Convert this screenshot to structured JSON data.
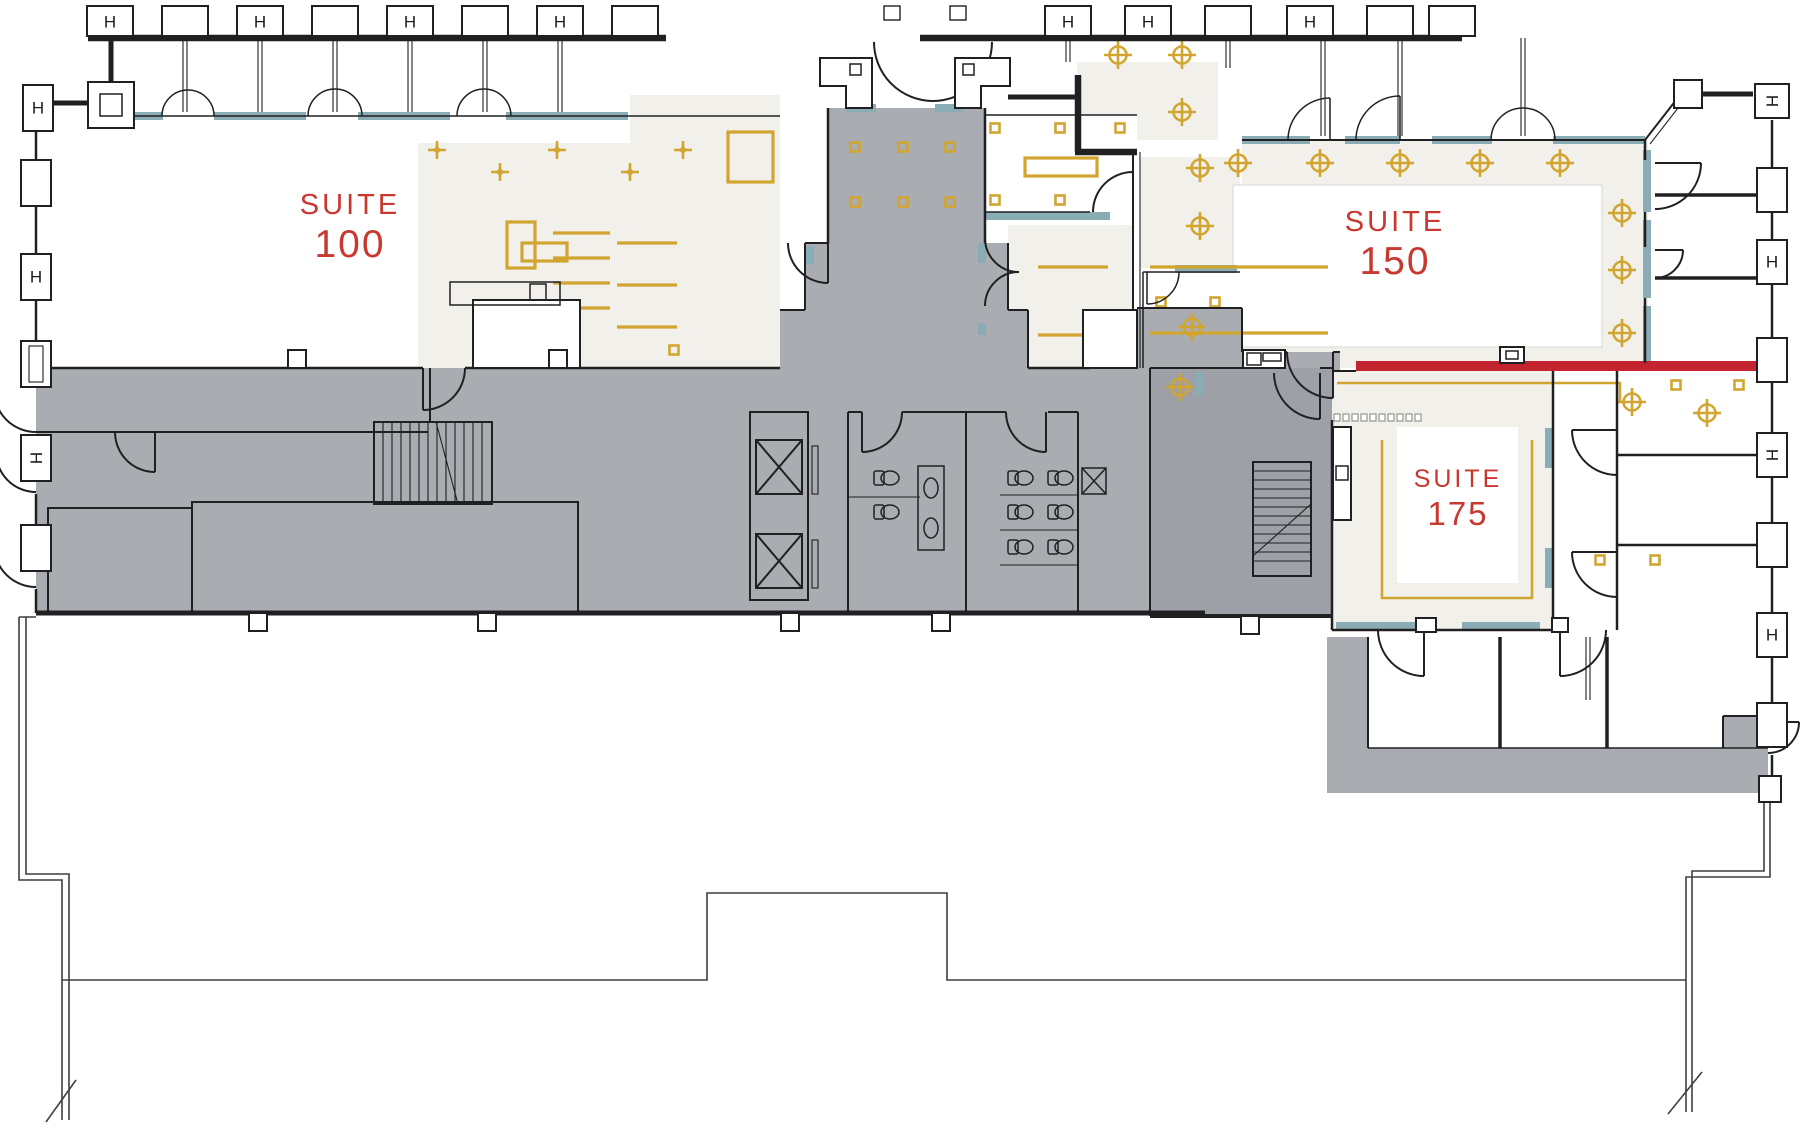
{
  "plan": {
    "type": "office-building-leasing-floor-plan",
    "suites": {
      "suite_100": {
        "name_line": "SUITE",
        "number_line": "100"
      },
      "suite_150": {
        "name_line": "SUITE",
        "number_line": "150"
      },
      "suite_175": {
        "name_line": "SUITE",
        "number_line": "175"
      }
    },
    "symbols": {
      "column_glyph_h": "H",
      "ceiling_light_icon": "crosshair-circle",
      "sprinkler_icon": "four-point-sparkle",
      "ceiling_grid_marker_icon": "small-gold-square",
      "elevator_icon": "x-crossed-shaft",
      "stair_icon": "treads-with-break-line",
      "exit_path_icon": "thin-double-line-with-arrow"
    },
    "colors": {
      "corridor_gray": "#a9acb1",
      "stair_core_gray": "#9da0a6",
      "suite_cream": "#f1f0ea",
      "window_sill_teal": "#8aacb4",
      "accent_gold": "#d1a52f",
      "suite_label_red": "#c8382f",
      "demising_line_red": "#c32430",
      "wall_black": "#202023",
      "outline_gray": "#3f3f42"
    }
  }
}
